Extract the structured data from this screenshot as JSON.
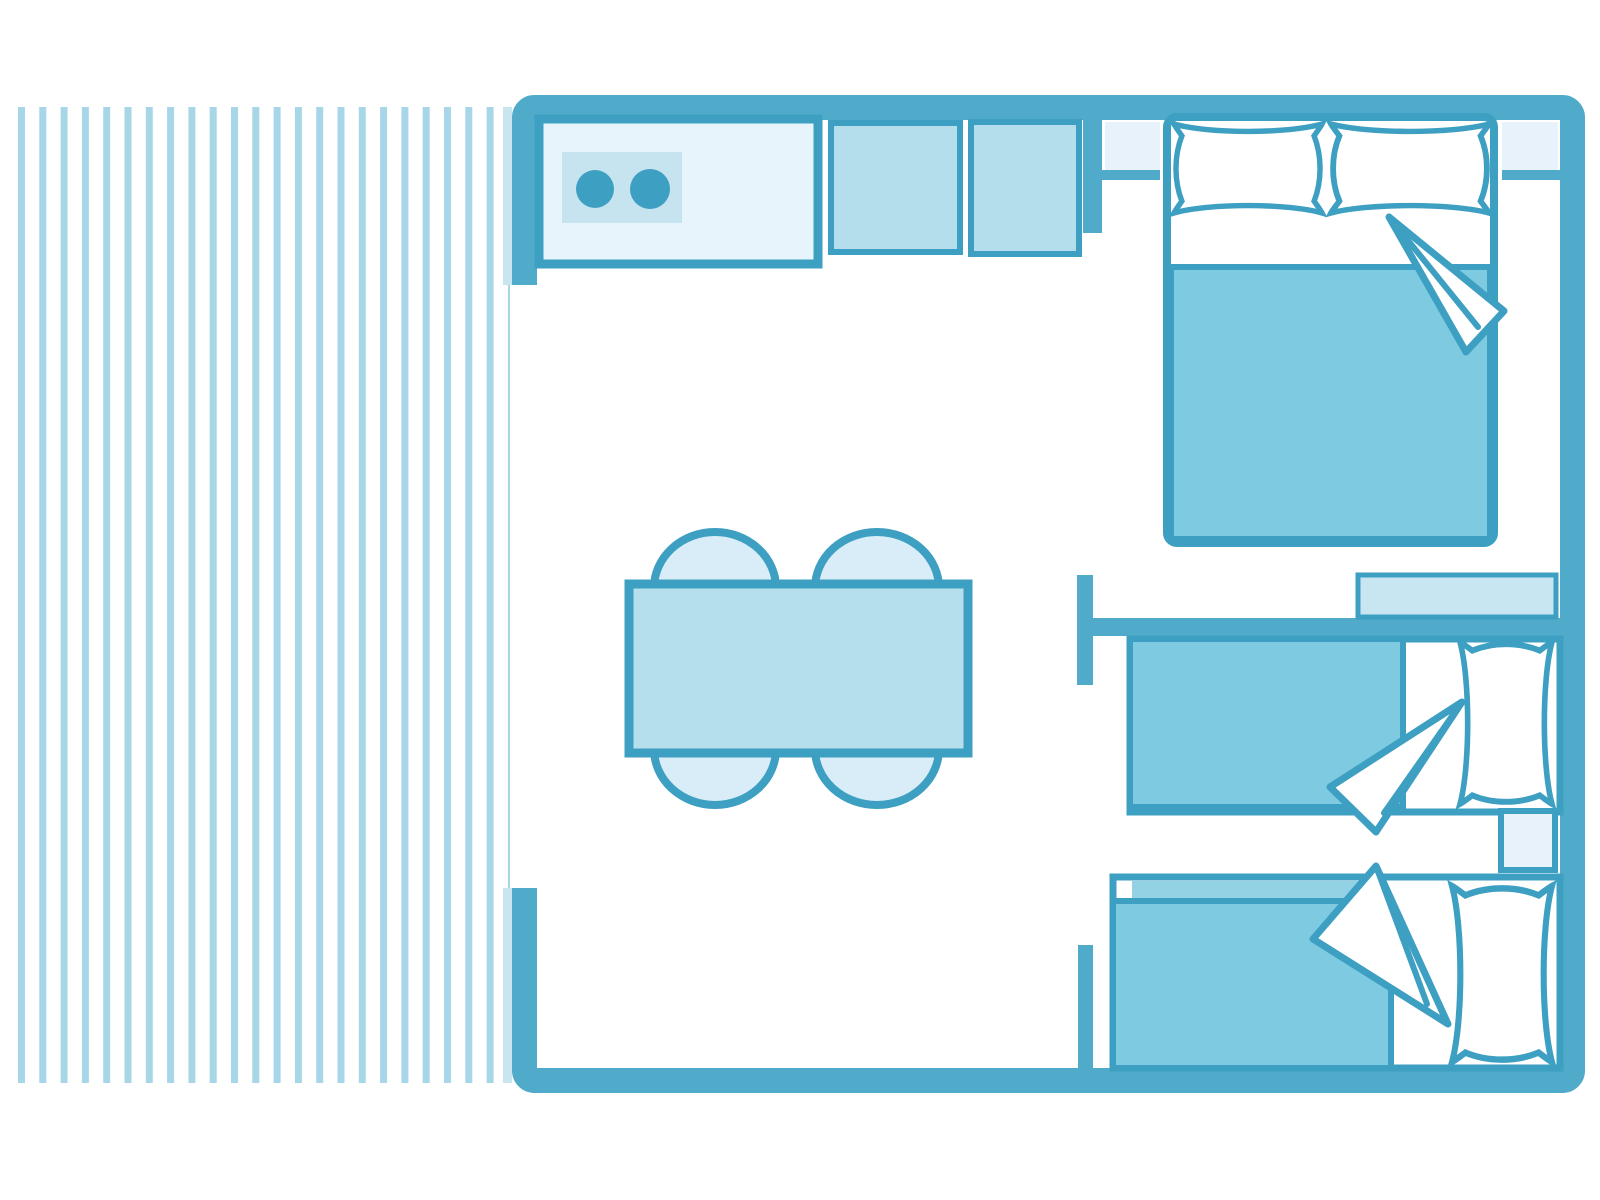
{
  "diagram": {
    "kind": "floor-plan",
    "style": "monochrome-teal line art, top-down view"
  },
  "colors": {
    "wall": "#4FABC9",
    "stroke": "#3D9FC1",
    "floor": "#FFFFFF",
    "stripe": "#A6D6E7",
    "stripe_pale": "#C9E5F0",
    "counter": "#E7F4FB",
    "stove": "#C6E4F0",
    "burner": "#3D9FC1",
    "cabinet": "#B5DEEC",
    "table": "#B5DFEC",
    "chair": "#D8EDF7",
    "blanket": "#7ECBE1",
    "band": "#93D2E4",
    "pillow": "#FFFFFF",
    "nightstand": "#E7F2FA",
    "shelf": "#C8E6F2"
  },
  "areas": {
    "terrace": {
      "name": "striped deck terrace",
      "stripe_count": 24,
      "items": [
        "decking-stripes"
      ]
    },
    "kitchen": {
      "name": "kitchen corner",
      "items": [
        "worktop-counter",
        "two-burner-stove",
        "cabinet-unit",
        "cabinet-unit"
      ]
    },
    "living_dining": {
      "name": "open living dining area",
      "items": [
        "dining-table",
        "chair",
        "chair",
        "chair",
        "chair"
      ]
    },
    "bedroom_double": {
      "name": "double bedroom",
      "items": [
        "double-bed",
        "pillow",
        "pillow",
        "folded-sheet-corner",
        "nightstand",
        "nightstand"
      ]
    },
    "bedroom_twin": {
      "name": "twin bedroom",
      "items": [
        "single-bed",
        "single-bed",
        "pillow",
        "pillow",
        "folded-sheet-corner",
        "folded-sheet-corner",
        "nightstand",
        "storage-shelf"
      ]
    }
  }
}
